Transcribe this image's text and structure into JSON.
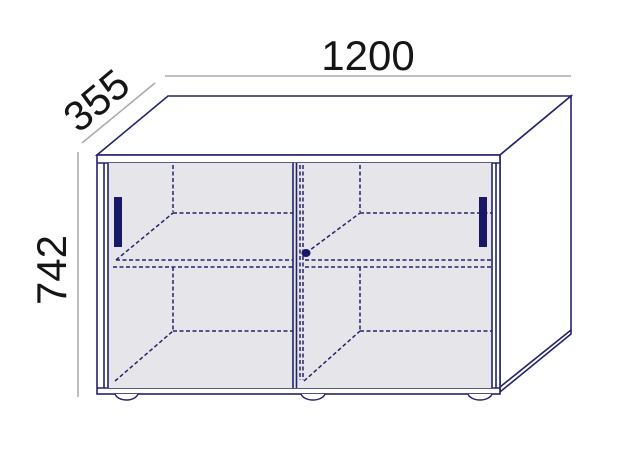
{
  "diagram": {
    "subject": "sideboard-with-sliding-doors-dimension-drawing",
    "dimensions": {
      "width": "1200",
      "depth": "355",
      "height": "742"
    },
    "colors": {
      "outline": "#23236b",
      "handle_accent": "#181868",
      "door_fill": "#e6e6ea",
      "dimension_line": "#a8a8a8",
      "label_text": "#151515",
      "background": "#ffffff"
    }
  }
}
